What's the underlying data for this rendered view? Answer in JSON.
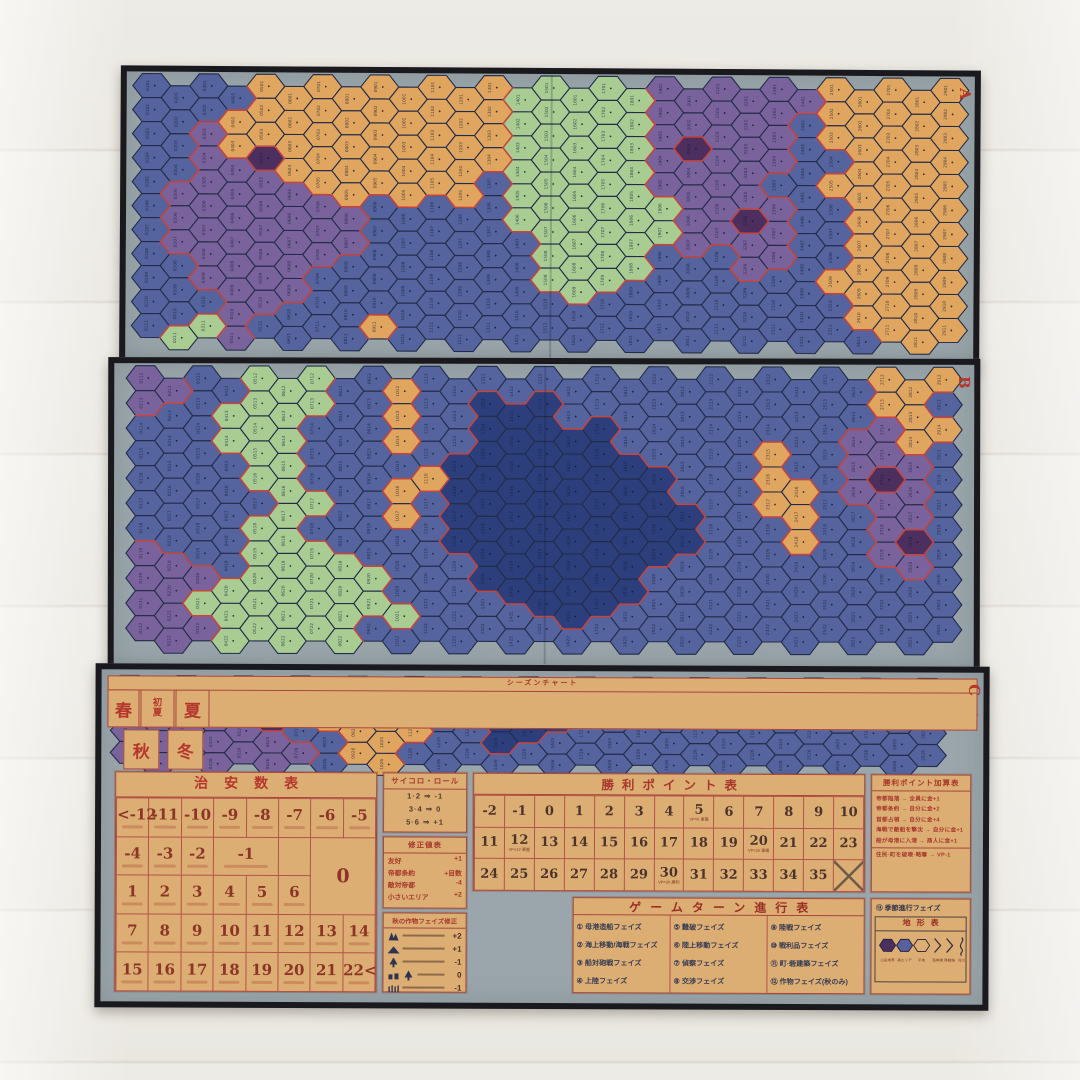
{
  "colors": {
    "sea": "#55639e",
    "deep_sea": "#2c3f7c",
    "plains": "#e0a55e",
    "forest": "#a8cc92",
    "highland": "#7a639c",
    "mountain": "#4c2f5e",
    "board_margin": "#9aa6ab",
    "frame": "#1a1a1e",
    "chart_paper": "#dcae74",
    "accent_red": "#b5372c"
  },
  "panels": {
    "a": {
      "label": "A",
      "grid": [
        "BBBBOOOOOOOOOGGGGGPPPPPPOOOOO",
        "BBBOOOOOOOOOOGGGGGPPPPPBOOOOO",
        "BBPOOOOOOOOOOGGGGGPQPPPBOOOOO",
        "BBPPQOOOOOOOOGGGGGPPPPPBBOOOO",
        "BPPPPPOOOOOOBGGGGGPPPPBBOOOOO",
        "BPPPPPPPBBBBBGGGGGGPPQPBBOOOO",
        "BPPPPPPPBBBBBBGGGGGPPPPBBOOOO",
        "BBPPPPPBBBBBBBGGGGBBBPPBBOOOO",
        "BBPPPPBBBBBBBBGGGBBBBBBBOOOOO",
        "BBBPPBBBBBBBBBBBBBBBBBBBBOOOO",
        "BGGPBBBBOBBBBBBBBBBBBBBBBBOOO"
      ]
    },
    "b": {
      "label": "B",
      "grid": [
        "PPBBGGGBBOBBBBBBBBBBBBBBBBOOO",
        "PBBGGGGBBOBBDDDBBBBBBBBBBBOOB",
        "BBBGGGBBBOBBDDDDDBBBBBBBBPPOO",
        "BBBBGGBBBBBDDDDDDDBBBBOBBPPPB",
        "BBBBGGBBBOODDDDDDDDBBBOOBPQPB",
        "BBBBBGGBBOBDDDDDDDDDBBOOBBPPB",
        "BBBBGGBBBBBDDDDDDDDDBBBOBBPQB",
        "PPBBGGGGBBBBDDDDDDDBBBBBBBPPB",
        "PPPGGGGGGBBBDDDDDDBBBBBBBBBBB",
        "PPGGGGGGGGBBBBDDDBBBBBBBBBBBB",
        "PPPGGGGGBBBBBBBBBBBBBBBBBBBBB"
      ]
    },
    "c": {
      "label": "C",
      "grid": [
        "PQPPPPBOOOBBBDDBBBBBBBBBBBBBB",
        "PPPPPQBOOOOBBDDDBBBBBBBBBBBBB",
        "PPPPPPBBOOOBBDDBBBBBBBBBBBBBB",
        "PPPPPPPBOOBBBBBBBBBBBBBBBBBBB"
      ]
    }
  },
  "nations": [
    {
      "label": "イギリス",
      "color": "#c8394a",
      "flag": "uk"
    },
    {
      "label": "フランス",
      "color": "#2d5fa8",
      "flag": "france"
    },
    {
      "label": "スペイン",
      "color": "#2f8f55",
      "flag": "spain"
    },
    {
      "label": "ポルトガル",
      "color": "#e6c34e",
      "flag": "portugal"
    },
    {
      "label": "オランダ",
      "color": "#d689a6",
      "flag": "netherlands"
    }
  ],
  "security_table": {
    "title": "治安数表",
    "rows": [
      {
        "cells": [
          {
            "t": "<-12"
          },
          {
            "t": "-11"
          },
          {
            "t": "-10"
          },
          {
            "t": "-9"
          },
          {
            "t": "-8"
          },
          {
            "t": "-7"
          },
          {
            "t": "-6"
          },
          {
            "t": "-5"
          }
        ]
      },
      {
        "cells": [
          {
            "t": "-4"
          },
          {
            "t": "-3"
          },
          {
            "t": "-2"
          },
          {
            "t": "-1",
            "span": 2
          },
          {
            "t": ""
          },
          {
            "t": "0",
            "span": 2,
            "rowspan": 2
          }
        ]
      },
      {
        "cells": [
          {
            "t": "1"
          },
          {
            "t": "2"
          },
          {
            "t": "3"
          },
          {
            "t": "4"
          },
          {
            "t": "5"
          },
          {
            "t": "6"
          }
        ]
      },
      {
        "cells": [
          {
            "t": "7"
          },
          {
            "t": "8"
          },
          {
            "t": "9"
          },
          {
            "t": "10"
          },
          {
            "t": "11"
          },
          {
            "t": "12"
          },
          {
            "t": "13"
          },
          {
            "t": "14"
          }
        ]
      },
      {
        "cells": [
          {
            "t": "15"
          },
          {
            "t": "16"
          },
          {
            "t": "17"
          },
          {
            "t": "18"
          },
          {
            "t": "19"
          },
          {
            "t": "20"
          },
          {
            "t": "21"
          },
          {
            "t": "22<"
          }
        ]
      }
    ]
  },
  "dice_box": {
    "title": "サイコロ・ロール",
    "lines": [
      "1·2 ⇒ -1",
      "3·4 ⇒ 0",
      "5·6 ⇒ +1"
    ]
  },
  "modifier_box": {
    "title": "修正値表",
    "lines": [
      [
        "友好",
        "+1"
      ],
      [
        "帝都条約",
        "+目数"
      ],
      [
        "敵対帝都",
        "-4"
      ],
      [
        "小さいエリア",
        "+2"
      ]
    ]
  },
  "crop_box": {
    "title": "秋の作物フェイズ修正",
    "rows": [
      {
        "icons": [
          "forest-icon"
        ],
        "value": "+2"
      },
      {
        "icons": [
          "hill-icon"
        ],
        "value": "+1"
      },
      {
        "icons": [
          "tree-icon"
        ],
        "value": "-1"
      },
      {
        "icons": [
          "village-icon",
          "tree-icon"
        ],
        "value": "0"
      },
      {
        "icons": [
          "grass-icon"
        ],
        "value": "-1"
      }
    ]
  },
  "vp_table": {
    "title": "勝利ポイント表",
    "rows": [
      [
        {
          "t": "-2"
        },
        {
          "t": "-1"
        },
        {
          "t": "0"
        },
        {
          "t": "1"
        },
        {
          "t": "2"
        },
        {
          "t": "3"
        },
        {
          "t": "4"
        },
        {
          "t": "5",
          "cap": "VP=5·軍艦"
        },
        {
          "t": "6"
        },
        {
          "t": "7"
        },
        {
          "t": "8"
        },
        {
          "t": "9"
        },
        {
          "t": "10"
        }
      ],
      [
        {
          "t": "11"
        },
        {
          "t": "12",
          "cap": "VP=12·軍艦"
        },
        {
          "t": "13"
        },
        {
          "t": "14"
        },
        {
          "t": "15"
        },
        {
          "t": "16"
        },
        {
          "t": "17"
        },
        {
          "t": "18"
        },
        {
          "t": "19"
        },
        {
          "t": "20",
          "cap": "VP=20·軍艦"
        },
        {
          "t": "21"
        },
        {
          "t": "22"
        },
        {
          "t": "23"
        }
      ],
      [
        {
          "t": "24"
        },
        {
          "t": "25"
        },
        {
          "t": "26"
        },
        {
          "t": "27"
        },
        {
          "t": "28"
        },
        {
          "t": "29"
        },
        {
          "t": "30",
          "cap": "VP=30·勝利"
        },
        {
          "t": "31"
        },
        {
          "t": "32"
        },
        {
          "t": "33"
        },
        {
          "t": "34"
        },
        {
          "t": "35"
        },
        {
          "t": "",
          "crossed": true
        }
      ]
    ]
  },
  "vp_bonus_box": {
    "title": "勝利ポイント加算表",
    "lines": [
      "帝都陥落 → 全員に金+1",
      "帝都条約 → 自分に金+2",
      "首都占領 → 自分に金+4",
      "海戦で敵船を撃沈 → 自分に金+1",
      "船が母港に入港 → 商人に金+1"
    ],
    "footer": "住民·町を破壊·略奪 → VP-1"
  },
  "season_chart": {
    "title": "シーズンチャート",
    "cells": [
      "春",
      "初夏",
      "夏",
      "秋",
      "冬"
    ]
  },
  "turn_table": {
    "title": "ゲームターン進行表",
    "phases": [
      {
        "n": "①",
        "t": "母港造船フェイズ"
      },
      {
        "n": "②",
        "t": "海上移動/海戦フェイズ"
      },
      {
        "n": "③",
        "t": "船対砲戦フェイズ"
      },
      {
        "n": "④",
        "t": "上陸フェイズ"
      },
      {
        "n": "⑤",
        "t": "難破フェイズ"
      },
      {
        "n": "⑥",
        "t": "陸上移動フェイズ"
      },
      {
        "n": "⑦",
        "t": "偵察フェイズ"
      },
      {
        "n": "⑧",
        "t": "交渉フェイズ"
      },
      {
        "n": "⑨",
        "t": "陸戦フェイズ"
      },
      {
        "n": "⑩",
        "t": "戦利品フェイズ"
      },
      {
        "n": "⑪",
        "t": "町·砦建築フェイズ"
      },
      {
        "n": "⑫",
        "t": "作物フェイズ(秋のみ)"
      }
    ]
  },
  "season_phase": {
    "n": "⑬",
    "t": "季節進行フェイズ"
  },
  "terrain_table": {
    "title": "地形表",
    "items": [
      {
        "icon": "mountain-hex-icon",
        "label": "山岳地帯"
      },
      {
        "icon": "highland-hex-icon",
        "label": "森エリア"
      },
      {
        "icon": "open-hex-icon",
        "label": "平地"
      },
      {
        "icon": "coast-chevron-icon",
        "label": "海岸線"
      },
      {
        "icon": "border-chevron-icon",
        "label": "移動路"
      },
      {
        "icon": "river-wave-icon",
        "label": "河川"
      }
    ]
  }
}
